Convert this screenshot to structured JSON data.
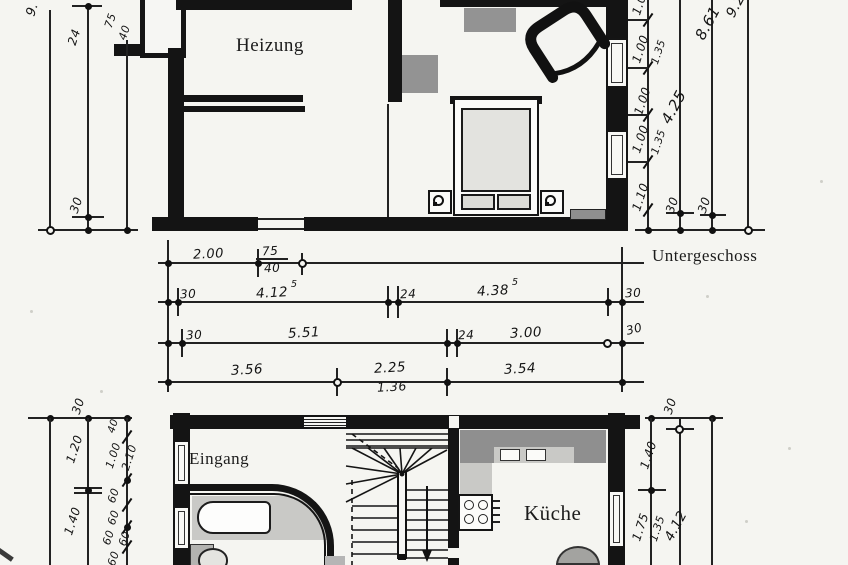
{
  "floor_label": "Untergeschoss",
  "rooms": {
    "heizung": "Heizung",
    "eingang": "Eingang",
    "kueche": "Küche"
  },
  "dims": {
    "ul_total": "9.",
    "ul_24": "24",
    "ul_75": "75",
    "ul_40": "40",
    "ul_30": "30",
    "ur_seg1": "1.00",
    "ur_seg2a": "1.00",
    "ur_seg2b": "1.35",
    "ur_seg3": "1.00",
    "ur_seg4a": "1.00",
    "ur_seg4b": "1.35",
    "ur_seg5": "1.10",
    "ur_30a": "30",
    "ur_30b": "30",
    "ur_425": "4.25",
    "ur_861": "8.61",
    "ur_92": "9.2",
    "rowA_200": "2.00",
    "rowA_75": "75",
    "rowA_40": "40",
    "rowB_30l": "30",
    "rowB_412": "4.12",
    "rowB_412sup": "5",
    "rowB_24": "24",
    "rowB_438": "4.38",
    "rowB_438sup": "5",
    "rowB_30r": "30",
    "rowC_30l": "30",
    "rowC_551": "5.51",
    "rowC_24": "24",
    "rowC_300": "3.00",
    "rowC_30r": "30",
    "rowD_356": "3.56",
    "rowD_225": "2.25",
    "rowD_136": "1.36",
    "rowD_354": "3.54",
    "ll_30": "30",
    "ll_120": "1.20",
    "ll_140": "1.40",
    "ll_40": "40",
    "ll_100": "1.00",
    "ll_210": "2.10",
    "ll_60a": "60",
    "ll_60b": "60",
    "ll_60c": "60",
    "ll_60d": "60",
    "ll_60e": "60",
    "lr_30": "30",
    "lr_140": "1.40",
    "lr_175": "1.75",
    "lr_135": "1.35",
    "lr_412": "4.12"
  }
}
